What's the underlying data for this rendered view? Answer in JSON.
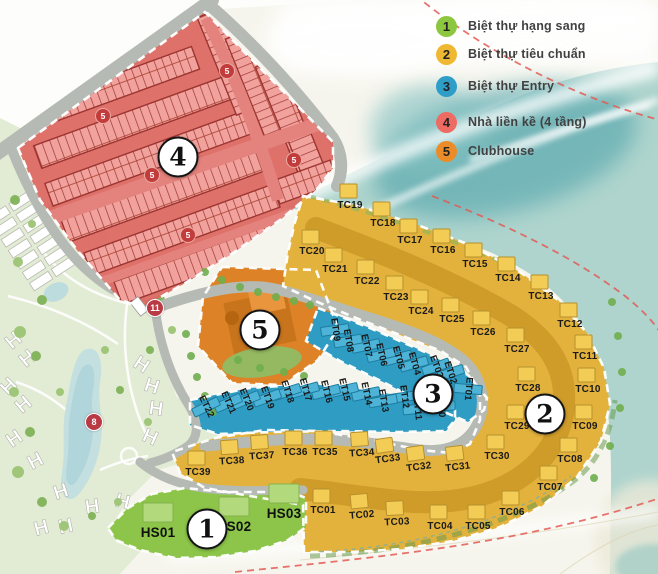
{
  "legend": {
    "items": [
      {
        "number": "1",
        "label": "Biệt thự hạng sang",
        "color": "#8dc63f"
      },
      {
        "number": "2",
        "label": "Biệt thự tiêu chuẩn",
        "color": "#efb832"
      },
      {
        "number": "3",
        "label": "Biệt thự Entry",
        "color": "#2e9dc8"
      },
      {
        "number": "4",
        "label": "Nhà liền kề (4 tầng)",
        "color": "#ee6b63"
      },
      {
        "number": "5",
        "label": "Clubhouse",
        "color": "#ec8c28"
      }
    ]
  },
  "zones": [
    {
      "id": "1",
      "name": "Biệt thự hạng sang",
      "color": "#8cc549",
      "marker": {
        "x": 207,
        "y": 529
      }
    },
    {
      "id": "2",
      "name": "Biệt thự tiêu chuẩn",
      "color": "#e3b23c",
      "marker": {
        "x": 545,
        "y": 414
      }
    },
    {
      "id": "3",
      "name": "Biệt thự Entry",
      "color": "#2f9cc3",
      "marker": {
        "x": 433,
        "y": 394
      }
    },
    {
      "id": "4",
      "name": "Nhà liền kề (4 tầng)",
      "color": "#dc6a63",
      "marker": {
        "x": 178,
        "y": 157
      }
    },
    {
      "id": "5",
      "name": "Clubhouse",
      "color": "#dd8226",
      "marker": {
        "x": 260,
        "y": 330
      }
    }
  ],
  "road_badges": [
    {
      "label": "8",
      "x": 94,
      "y": 422
    },
    {
      "label": "11",
      "x": 155,
      "y": 308
    }
  ],
  "block_badges": [
    {
      "label": "5",
      "x": 103,
      "y": 116
    },
    {
      "label": "5",
      "x": 152,
      "y": 175
    },
    {
      "label": "5",
      "x": 227,
      "y": 71
    },
    {
      "label": "5",
      "x": 188,
      "y": 235
    },
    {
      "label": "5",
      "x": 294,
      "y": 160
    }
  ],
  "lots": {
    "tc": [
      {
        "id": "TC01",
        "x": 323,
        "y": 511
      },
      {
        "id": "TC02",
        "x": 362,
        "y": 516,
        "rot": -5
      },
      {
        "id": "TC03",
        "x": 397,
        "y": 523,
        "rot": -3
      },
      {
        "id": "TC04",
        "x": 440,
        "y": 527
      },
      {
        "id": "TC05",
        "x": 478,
        "y": 527
      },
      {
        "id": "TC06",
        "x": 512,
        "y": 513
      },
      {
        "id": "TC07",
        "x": 550,
        "y": 488
      },
      {
        "id": "TC08",
        "x": 570,
        "y": 460
      },
      {
        "id": "TC09",
        "x": 585,
        "y": 427
      },
      {
        "id": "TC10",
        "x": 588,
        "y": 390
      },
      {
        "id": "TC11",
        "x": 585,
        "y": 357
      },
      {
        "id": "TC12",
        "x": 570,
        "y": 325
      },
      {
        "id": "TC13",
        "x": 541,
        "y": 297
      },
      {
        "id": "TC14",
        "x": 508,
        "y": 279
      },
      {
        "id": "TC15",
        "x": 475,
        "y": 265
      },
      {
        "id": "TC16",
        "x": 443,
        "y": 251
      },
      {
        "id": "TC17",
        "x": 410,
        "y": 241
      },
      {
        "id": "TC18",
        "x": 383,
        "y": 224
      },
      {
        "id": "TC19",
        "x": 350,
        "y": 206
      },
      {
        "id": "TC20",
        "x": 312,
        "y": 252
      },
      {
        "id": "TC21",
        "x": 335,
        "y": 270
      },
      {
        "id": "TC22",
        "x": 367,
        "y": 282
      },
      {
        "id": "TC23",
        "x": 396,
        "y": 298
      },
      {
        "id": "TC24",
        "x": 421,
        "y": 312
      },
      {
        "id": "TC25",
        "x": 452,
        "y": 320
      },
      {
        "id": "TC26",
        "x": 483,
        "y": 333
      },
      {
        "id": "TC27",
        "x": 517,
        "y": 350
      },
      {
        "id": "TC28",
        "x": 528,
        "y": 389
      },
      {
        "id": "TC29",
        "x": 517,
        "y": 427
      },
      {
        "id": "TC30",
        "x": 497,
        "y": 457
      },
      {
        "id": "TC31",
        "x": 458,
        "y": 468,
        "rot": -7
      },
      {
        "id": "TC32",
        "x": 419,
        "y": 468,
        "rot": -8
      },
      {
        "id": "TC33",
        "x": 388,
        "y": 460,
        "rot": -8
      },
      {
        "id": "TC34",
        "x": 362,
        "y": 454,
        "rot": -4
      },
      {
        "id": "TC35",
        "x": 325,
        "y": 453
      },
      {
        "id": "TC36",
        "x": 295,
        "y": 453
      },
      {
        "id": "TC37",
        "x": 262,
        "y": 457,
        "rot": -4
      },
      {
        "id": "TC38",
        "x": 232,
        "y": 462,
        "rot": -4
      },
      {
        "id": "TC39",
        "x": 198,
        "y": 473
      }
    ],
    "et": [
      {
        "id": "ET01",
        "x": 468,
        "y": 389,
        "rot": 95
      },
      {
        "id": "ET02",
        "x": 450,
        "y": 373,
        "rot": 72
      },
      {
        "id": "ET03",
        "x": 436,
        "y": 367,
        "rot": 70
      },
      {
        "id": "ET04",
        "x": 414,
        "y": 364,
        "rot": 74
      },
      {
        "id": "ET05",
        "x": 398,
        "y": 358,
        "rot": 75
      },
      {
        "id": "ET06",
        "x": 381,
        "y": 355,
        "rot": 77
      },
      {
        "id": "ET07",
        "x": 366,
        "y": 346,
        "rot": 78
      },
      {
        "id": "ET08",
        "x": 348,
        "y": 341,
        "rot": 80
      },
      {
        "id": "ET09",
        "x": 335,
        "y": 330,
        "rot": 82
      },
      {
        "id": "ET10",
        "x": 441,
        "y": 406,
        "rot": 88
      },
      {
        "id": "ET11",
        "x": 417,
        "y": 409,
        "rot": 84
      },
      {
        "id": "ET12",
        "x": 404,
        "y": 397,
        "rot": 82
      },
      {
        "id": "ET13",
        "x": 383,
        "y": 401,
        "rot": 80
      },
      {
        "id": "ET14",
        "x": 366,
        "y": 394,
        "rot": 78
      },
      {
        "id": "ET15",
        "x": 344,
        "y": 390,
        "rot": 77
      },
      {
        "id": "ET16",
        "x": 326,
        "y": 392,
        "rot": 76
      },
      {
        "id": "ET17",
        "x": 305,
        "y": 390,
        "rot": 74
      },
      {
        "id": "ET18",
        "x": 287,
        "y": 392,
        "rot": 72
      },
      {
        "id": "ET19",
        "x": 267,
        "y": 398,
        "rot": 70
      },
      {
        "id": "ET20",
        "x": 246,
        "y": 400,
        "rot": 68
      },
      {
        "id": "ET21",
        "x": 228,
        "y": 403,
        "rot": 66
      },
      {
        "id": "ET22",
        "x": 206,
        "y": 407,
        "rot": 64
      }
    ],
    "hs": [
      {
        "id": "HS01",
        "x": 158,
        "y": 533
      },
      {
        "id": "HS02",
        "x": 234,
        "y": 527
      },
      {
        "id": "HS03",
        "x": 284,
        "y": 514
      }
    ]
  }
}
